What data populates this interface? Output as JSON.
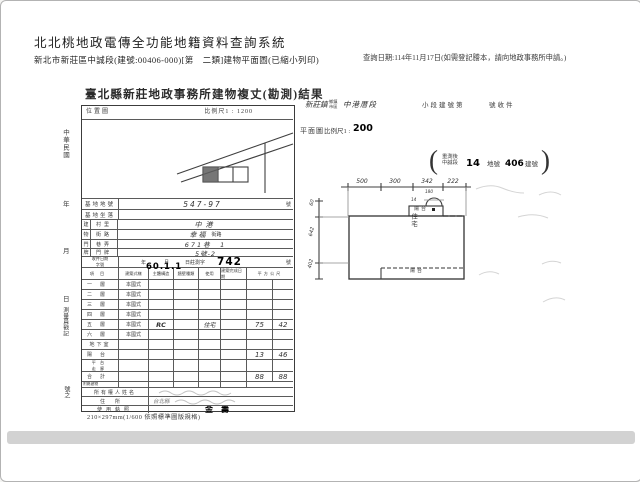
{
  "app": {
    "title": "北北桃地政電傳全功能地籍資料查詢系統",
    "subtitle": "新北市新莊區中誠段(建號:00406-000)[第　二類]建物平面圖(已縮小列印)",
    "query_note": "查詢日期:114年11月17日(如需登記謄本，請向地政事務所申請。)"
  },
  "document": {
    "title": "臺北縣新莊地政事務所建物複丈(勘測)結果",
    "margin": {
      "era": "中華民國",
      "year": "年",
      "month": "月",
      "day": "日",
      "surveyor": "測量員戳記",
      "tail": "號之"
    },
    "location_map": {
      "label": "位置圖",
      "scale": "比例尺1 : 1200"
    },
    "site": {
      "lot_label": "基地地號",
      "lot_value": "547-97",
      "lot_suffix": "號",
      "sit_label": "基地坐落",
      "door_group": [
        "建",
        "物",
        "門",
        "牌"
      ],
      "rows": [
        {
          "label": "村里",
          "value": "中港",
          "suffix": ""
        },
        {
          "label": "街路",
          "value": "幸福",
          "suffix": "街路"
        },
        {
          "label": "巷弄",
          "value": "671巷　1",
          "suffix": ""
        },
        {
          "label": "門牌",
          "value": "5號-2",
          "suffix": ""
        }
      ],
      "receipt_label_1": "收件日期",
      "receipt_label_2": "字號",
      "receipt_year": "年",
      "receipt_month": "月",
      "receipt_day": "日莊測字",
      "receipt_no": "742",
      "receipt_suffix": "號"
    },
    "floor_table": {
      "headers": [
        "項目",
        "建築式樣",
        "主體構造",
        "牆壁種類",
        "使用",
        "建築完成日期",
        "平方公尺"
      ],
      "stamp": "60.1.1",
      "rows": [
        {
          "f": "一層",
          "s": "本國式",
          "st": "",
          "u": "",
          "a": "",
          "b": ""
        },
        {
          "f": "二層",
          "s": "本國式",
          "st": "",
          "u": "",
          "a": "",
          "b": ""
        },
        {
          "f": "三層",
          "s": "本國式",
          "st": "",
          "u": "",
          "a": "",
          "b": ""
        },
        {
          "f": "四層",
          "s": "本國式",
          "st": "",
          "u": "",
          "a": "",
          "b": ""
        },
        {
          "f": "五層",
          "s": "本國式",
          "st": "RC",
          "u": "住宅",
          "a": "75",
          "b": "42"
        },
        {
          "f": "六層",
          "s": "本國式",
          "st": "",
          "u": "",
          "a": "",
          "b": ""
        },
        {
          "f": "地下室",
          "s": "",
          "st": "",
          "u": "",
          "a": "",
          "b": ""
        },
        {
          "f": "陽台",
          "s": "",
          "st": "",
          "u": "",
          "a": "13",
          "b": "46"
        }
      ],
      "row_platform": {
        "f1": "平台",
        "f2": "走廊"
      },
      "row_total": {
        "f": "合計",
        "a": "88",
        "b": "88"
      },
      "row_annex": {
        "f": "附屬建物"
      }
    },
    "footer_rows": {
      "owner_label": "所有權人姓名",
      "addr_label": "住所",
      "addr_value": "台北縣",
      "license_label": "使用執照",
      "license_value": "金壽"
    },
    "caption": "210×297mm(1/600 依照標準圖版規格)"
  },
  "plan": {
    "header": {
      "town": "新莊鎮",
      "unit1": "鄉鎮",
      "unit2": "市區",
      "section": "中港厝段",
      "sub": "小段建號第",
      "receipt": "號收件"
    },
    "title": "平面圖",
    "scale_prefix": "比例尺1 :",
    "scale_value": "200",
    "note": {
      "open": "(",
      "l1": "重測後",
      "l2": "中誠段",
      "n1": "14",
      "m": "地號",
      "n2": "406",
      "t": "建號",
      "close": ")"
    },
    "top_dims": [
      "500",
      "300",
      "342",
      "222"
    ],
    "left_dims": [
      "60",
      "642",
      "402"
    ],
    "mini_dims": {
      "a": "180",
      "b": "14"
    },
    "labels": {
      "balcony_top": "陽台",
      "unit": "住宅",
      "balcony_bottom": "陽台"
    }
  }
}
